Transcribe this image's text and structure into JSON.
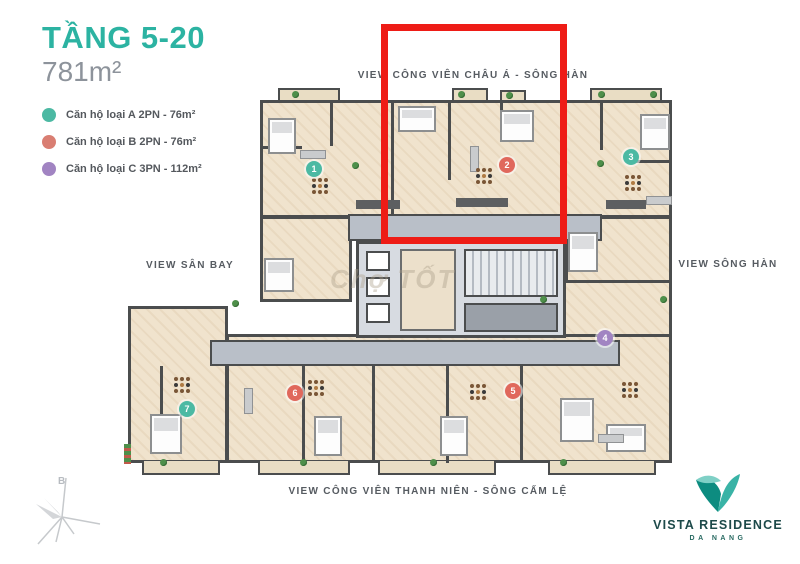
{
  "header": {
    "floor_range": "TẦNG 5-20",
    "area": "781m²"
  },
  "legend": [
    {
      "label": "Căn hộ loại A 2PN - 76m²",
      "color": "#4cb9a3"
    },
    {
      "label": "Căn hộ loại B 2PN - 76m²",
      "color": "#d97e72"
    },
    {
      "label": "Căn hộ loại C 3PN - 112m²",
      "color": "#a184c2"
    }
  ],
  "views": {
    "top": "VIEW CÔNG VIÊN CHÂU Á - SÔNG HÀN",
    "left": "VIEW SÂN BAY",
    "right": "VIEW SÔNG HÀN",
    "bottom": "VIEW CÔNG VIÊN THANH NIÊN - SÔNG CẤM LỆ"
  },
  "units": [
    {
      "number": "1",
      "type": "A",
      "color": "#4cb9a3"
    },
    {
      "number": "2",
      "type": "B",
      "color": "#e0685c"
    },
    {
      "number": "3",
      "type": "A",
      "color": "#4cb9a3"
    },
    {
      "number": "4",
      "type": "C",
      "color": "#a184c2"
    },
    {
      "number": "5",
      "type": "B",
      "color": "#e0685c"
    },
    {
      "number": "6",
      "type": "B",
      "color": "#e0685c"
    },
    {
      "number": "7",
      "type": "A",
      "color": "#4cb9a3"
    }
  ],
  "highlight_color": "#ee1c16",
  "compass": {
    "north_label": "B"
  },
  "logo": {
    "brand": "VISTA RESIDENCE",
    "city": "DA NANG"
  },
  "watermark": "Chợ TỐT"
}
